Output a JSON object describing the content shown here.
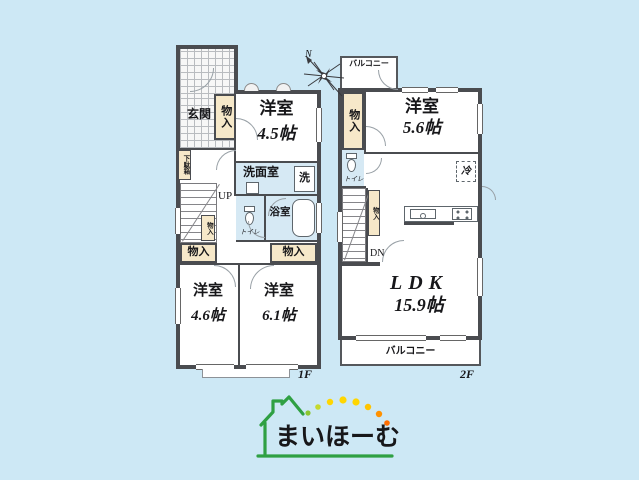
{
  "colors": {
    "background": "#cde8f5",
    "wall": "#4a4c50",
    "closet_fill": "#f6e8c9",
    "wet_area_fill": "#d6e9f4",
    "logo_green": "#2fa043",
    "dot_yellow": "#ffd600",
    "dot_orange": "#ff8f00"
  },
  "floor1": {
    "floor_label": "1F",
    "entrance": "玄関",
    "shoe_cabinet": "下駄箱",
    "closet": "物入",
    "stairs_up": "UP",
    "washroom": "洗面室",
    "laundry": "洗",
    "toilet": "トイレ",
    "bathroom": "浴室",
    "room_a": {
      "name": "洋室",
      "size": "4.5帖"
    },
    "room_b": {
      "name": "洋室",
      "size": "4.6帖"
    },
    "room_c": {
      "name": "洋室",
      "size": "6.1帖"
    }
  },
  "floor2": {
    "floor_label": "2F",
    "balcony": "バルコニー",
    "closet": "物入",
    "toilet": "トイレ",
    "fridge": "冷",
    "stairs_down": "DN",
    "room_a": {
      "name": "洋室",
      "size": "5.6帖"
    },
    "ldk": {
      "name": "LDK",
      "size": "15.9帖"
    }
  },
  "compass": {
    "north": "N"
  },
  "logo": {
    "brand": "まいほーむ"
  }
}
